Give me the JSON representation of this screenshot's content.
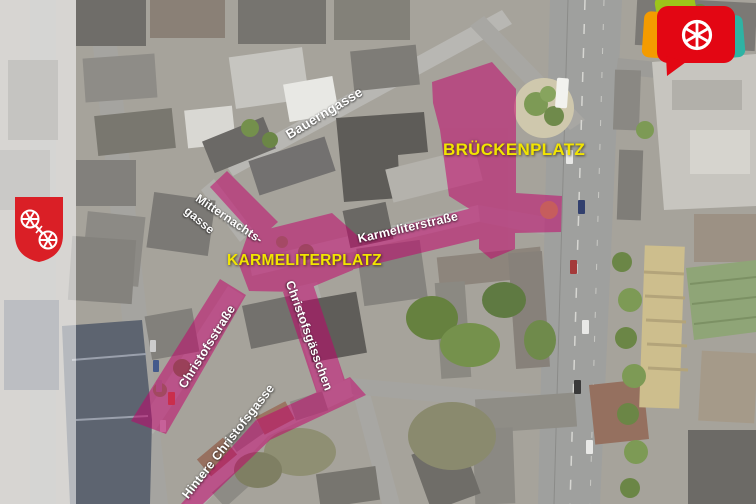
{
  "map": {
    "areas": {
      "brueckenplatz": "BRÜCKENPLATZ",
      "karmeliterplatz": "KARMELITERPLATZ"
    },
    "streets": {
      "bauerngasse": "Bauerngasse",
      "mitternachtsgasse_line1": "Mitternachts-",
      "mitternachtsgasse_line2": "gasse",
      "karmeliterstrasse": "Karmeliterstraße",
      "christofsstrasse": "Christofsstraße",
      "christofsgaesschen": "Christofsgässchen",
      "hintere_christofsgasse": "Hintere Christofsgasse"
    },
    "colors": {
      "highlight_magenta": "#c4006b",
      "area_label_yellow": "#f2e500",
      "street_label_white": "#ffffff",
      "logo_red": "#e30613",
      "logo_green": "#9dc41a",
      "logo_orange": "#f49b00",
      "logo_teal": "#2eb3a4",
      "shield_red": "#da1f26"
    },
    "icons": {
      "logo": "mainz-wheel-speech-bubble-logo",
      "shield": "mainz-coat-of-arms-shield"
    }
  }
}
